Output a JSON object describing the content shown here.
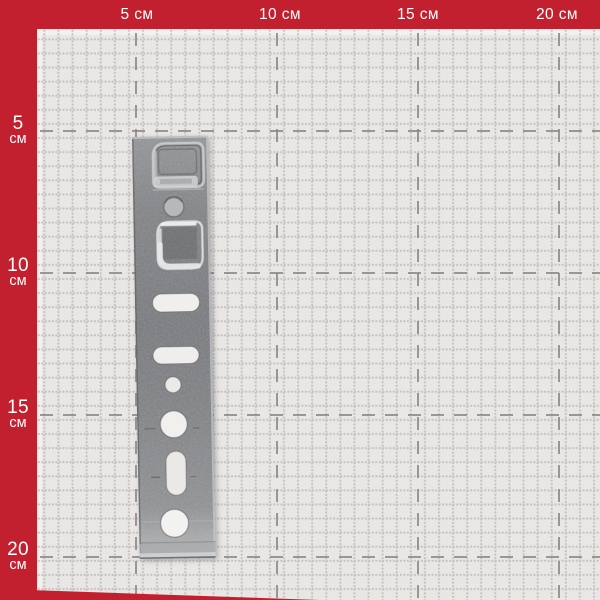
{
  "ruler": {
    "unit_label": "см",
    "top_labels": [
      "5 см",
      "10 см",
      "15 см",
      "20 см"
    ],
    "left_labels": [
      {
        "value": "5",
        "unit": "см"
      },
      {
        "value": "10",
        "unit": "см"
      },
      {
        "value": "15",
        "unit": "см"
      },
      {
        "value": "20",
        "unit": "см"
      }
    ]
  },
  "grid": {
    "major_interval_label": "5 см",
    "minor_square_cm": 0.5
  },
  "product": {
    "visible_object": "perforated-galvanized-anchor-plate"
  },
  "colors": {
    "frame_red": "#c2202e",
    "grid_bg": "#e9e7e5",
    "grid_edge_light": "#f2f1ef",
    "major_line": "#8e8884",
    "minor_dot": "#c5c2bf",
    "label_text": "#ffffff",
    "plate_metal": "#84868a",
    "hole_fill": "#f1efec"
  }
}
